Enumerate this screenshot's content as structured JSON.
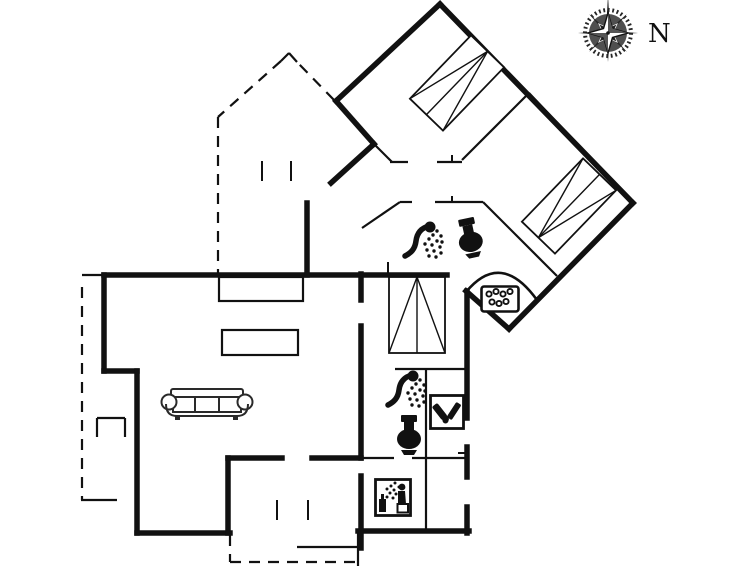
{
  "compass": {
    "label": "N",
    "cx": 608,
    "cy": 33,
    "label_dx": 40,
    "label_dy": 9
  },
  "colors": {
    "ink": "#111111",
    "bg": "#ffffff",
    "disc": "#4f4f4f",
    "dark": "#262626"
  },
  "floorplan": {
    "thick_walls": [
      [
        440,
        4,
        336,
        101
      ],
      [
        336,
        101,
        374,
        144
      ],
      [
        374,
        144,
        331,
        183
      ],
      [
        440,
        4,
        633,
        203
      ],
      [
        633,
        203,
        509,
        329
      ],
      [
        509,
        329,
        466,
        291
      ],
      [
        467,
        291,
        467,
        418
      ],
      [
        467,
        447,
        467,
        477
      ],
      [
        467,
        507,
        467,
        533
      ],
      [
        358,
        531,
        469,
        531
      ],
      [
        361,
        274,
        361,
        300
      ],
      [
        361,
        326,
        361,
        458
      ],
      [
        361,
        476,
        361,
        548
      ],
      [
        104,
        275,
        447,
        275
      ],
      [
        104,
        275,
        104,
        371
      ],
      [
        104,
        371,
        137,
        371
      ],
      [
        137,
        371,
        137,
        533
      ],
      [
        137,
        533,
        230,
        533
      ],
      [
        228,
        458,
        228,
        533
      ],
      [
        228,
        458,
        282,
        458
      ],
      [
        312,
        458,
        361,
        458
      ],
      [
        307,
        203,
        307,
        275
      ]
    ],
    "thin_walls": [
      [
        529,
        93,
        462,
        160
      ],
      [
        529,
        93,
        631,
        201
      ],
      [
        390,
        162,
        408,
        162
      ],
      [
        437,
        162,
        462,
        162
      ],
      [
        374,
        144,
        392,
        162
      ],
      [
        400,
        202,
        412,
        202
      ],
      [
        435,
        202,
        483,
        202
      ],
      [
        362,
        228,
        400,
        202
      ],
      [
        483,
        202,
        557,
        276
      ],
      [
        395,
        369,
        467,
        369
      ],
      [
        426,
        369,
        426,
        531
      ],
      [
        361,
        458,
        394,
        458
      ],
      [
        412,
        458,
        467,
        458
      ],
      [
        297,
        547,
        361,
        547
      ],
      [
        358,
        533,
        358,
        567
      ],
      [
        97,
        418,
        125,
        418
      ],
      [
        97,
        418,
        97,
        437
      ],
      [
        125,
        418,
        125,
        437
      ],
      [
        82,
        275,
        104,
        275
      ],
      [
        81,
        500,
        117,
        500
      ],
      [
        297,
        62,
        289,
        53
      ],
      [
        289,
        53,
        281,
        61
      ]
    ],
    "door_marks": [
      [
        262,
        161,
        262,
        181
      ],
      [
        291,
        161,
        291,
        181
      ],
      [
        277,
        500,
        277,
        520
      ],
      [
        308,
        500,
        308,
        520
      ],
      [
        452,
        155,
        452,
        162
      ],
      [
        452,
        196,
        452,
        202
      ],
      [
        458,
        453,
        467,
        453
      ],
      [
        388,
        262,
        388,
        274
      ]
    ],
    "dashed_walls": [
      [
        218,
        117,
        218,
        274
      ],
      [
        281,
        61,
        218,
        117
      ],
      [
        334,
        100,
        297,
        62
      ],
      [
        82,
        287,
        82,
        500
      ],
      [
        230,
        535,
        230,
        562
      ],
      [
        230,
        562,
        358,
        562
      ]
    ],
    "curved_wall": {
      "name": "curved-wall",
      "d": "M466,292 Q501,250 537,300"
    },
    "furniture_rects": [
      {
        "name": "wardrobe",
        "x": 219,
        "y": 277,
        "w": 84,
        "h": 24
      },
      {
        "name": "wardrobe",
        "x": 222,
        "y": 330,
        "w": 76,
        "h": 25
      }
    ],
    "beds": [
      {
        "name": "bed",
        "cx": 457,
        "cy": 83,
        "len": 88,
        "wid": 46,
        "angle": -46
      },
      {
        "name": "bed",
        "cx": 569,
        "cy": 206,
        "len": 88,
        "wid": 46,
        "angle": 134
      },
      {
        "name": "bed",
        "cx": 417,
        "cy": 315,
        "len": 76,
        "wid": 56,
        "angle": -90
      }
    ],
    "icons": [
      {
        "name": "shower-icon",
        "ref": "shower",
        "x": 396,
        "y": 219,
        "rot": 0
      },
      {
        "name": "toilet-icon",
        "ref": "toilet",
        "x": 449,
        "y": 221,
        "rot": -12
      },
      {
        "name": "whirlpool-icon",
        "ref": "whirlpool",
        "x": 480,
        "y": 285,
        "rot": 0
      },
      {
        "name": "shower-icon",
        "ref": "shower",
        "x": 379,
        "y": 368,
        "rot": 0
      },
      {
        "name": "toilet-icon",
        "ref": "toilet",
        "x": 392,
        "y": 414,
        "rot": 0
      },
      {
        "name": "washing-supplies-icon",
        "ref": "bottles",
        "x": 429,
        "y": 394,
        "rot": 0
      },
      {
        "name": "sauna-icon",
        "ref": "sauna",
        "x": 374,
        "y": 478,
        "rot": 0
      },
      {
        "name": "sofa",
        "ref": "sofa",
        "x": 161,
        "y": 382,
        "rot": 0
      }
    ]
  }
}
